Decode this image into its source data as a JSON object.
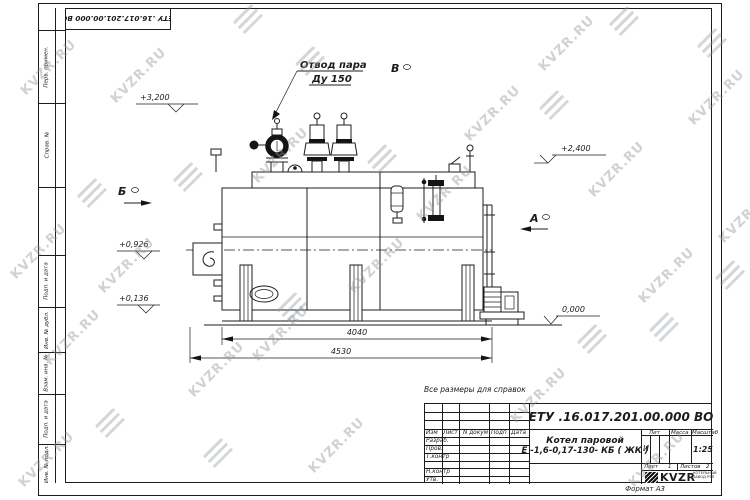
{
  "watermark": {
    "text": "KVZR.RU"
  },
  "top_stamp": {
    "doc_number": "ЕТУ .16.017.201.00.000  ВО"
  },
  "margin_labels": [
    "Перв. примен.",
    "Справ. №",
    "Подп. и дата",
    "Инв. № дубл.",
    "Взам. инв. №",
    "Подп. и дата",
    "Инв. № подл."
  ],
  "drawing": {
    "note": "Все размеры для справок",
    "labels": {
      "steam_outlet_line1": "Отвод пара",
      "steam_outlet_line2": "Ду 150",
      "view_a": "А",
      "view_b": "Б",
      "view_v": "В",
      "elev_top": "+3,200",
      "elev_right": "+2,400",
      "elev_burner": "+0,926",
      "elev_low": "+0,136",
      "elev_zero": "0,000",
      "dim_inner": "4040",
      "dim_outer": "4530"
    }
  },
  "title_block": {
    "doc_number": "ЕТУ .16.017.201.00.000  ВО",
    "name_line1": "Котел паровой",
    "name_line2": "Е -1,6-0,17-130- КБ ( ЖК )",
    "header": {
      "izm": "Изм",
      "list": "Лист",
      "n_dokum": "N докум",
      "podp": "Подп",
      "data": "Дата"
    },
    "rows": [
      "Разраб.",
      "Пров.",
      "Т.контр",
      "",
      "Н.контр",
      "Утв."
    ],
    "lit_label": "Лит",
    "massa_label": "Масса",
    "masshtab_label": "Масштаб",
    "lit_value": "И",
    "scale_value": "1:25",
    "sheet_label": "Лист",
    "sheet_value": "1",
    "sheets_label": "Листов",
    "sheets_value": "2",
    "company": {
      "logo_text": "KVZR",
      "sub_line1": "КОТЕЛЬНЫЙ",
      "sub_line2": "ЗАВОД РЭП"
    },
    "format_label": "Формат А3"
  }
}
